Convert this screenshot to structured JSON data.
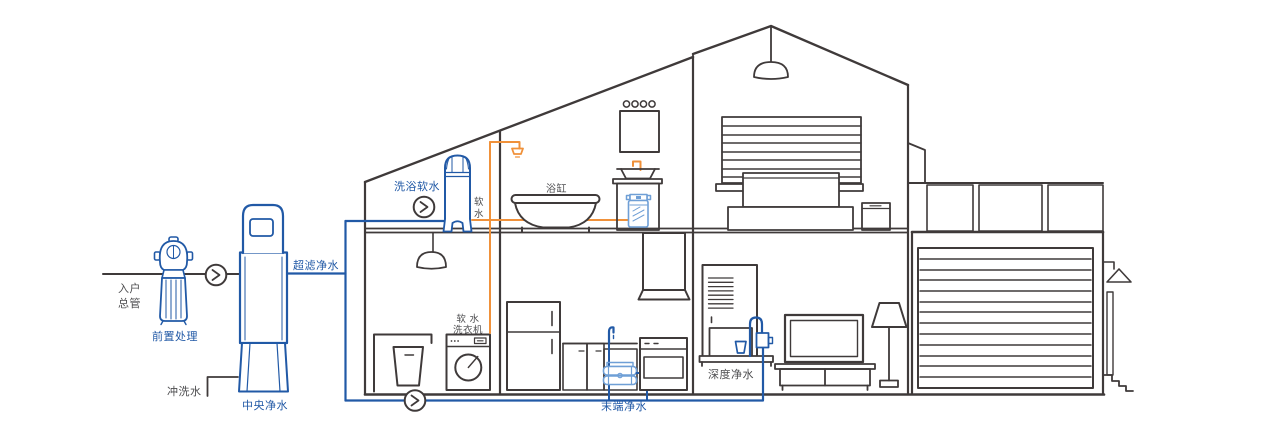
{
  "diagram": {
    "title": "whole-house water purification system in house cross-section",
    "colors": {
      "dark_line": "#3f3a3a",
      "blue": "#2159a6",
      "light_blue": "#6f9fd6",
      "orange": "#f0913a",
      "text_dark": "#4d4d4f",
      "background": "#ffffff"
    },
    "labels": {
      "entry_main_line1": "入户",
      "entry_main_line2": "总管",
      "pre_treatment": "前置处理",
      "flush_water": "冲洗水",
      "central_purifier": "中央净水",
      "ultrafiltration": "超滤净水",
      "bath_softener": "洗浴软水",
      "soft_water_char1": "软",
      "soft_water_char2": "水",
      "bathtub": "浴缸",
      "soft_washer_line1": "软 水",
      "soft_washer_line2": "洗衣机",
      "terminal_purifier": "末端净水",
      "deep_purifier": "深度净水"
    }
  }
}
